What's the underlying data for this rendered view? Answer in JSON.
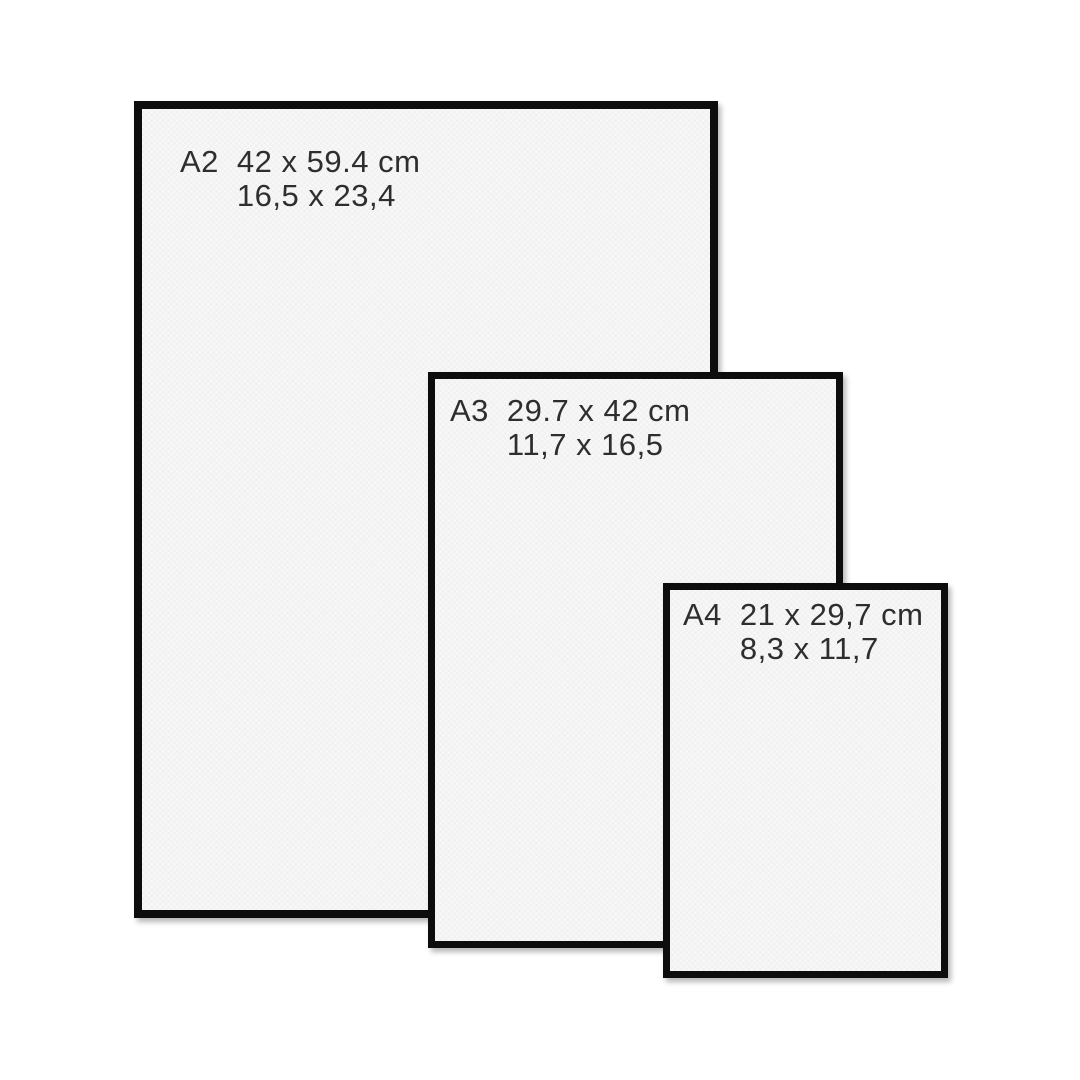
{
  "diagram": {
    "title": "frame-size-comparison",
    "colors": {
      "background": "#ffffff",
      "frame_border": "#0d0d0d",
      "paper": "#f8f8f8",
      "text": "#2e2e2e"
    }
  },
  "frames": [
    {
      "label": "A2",
      "size_cm": "42 x 59.4 cm",
      "size_inches": "16,5 x 23,4"
    },
    {
      "label": "A3",
      "size_cm": "29.7 x 42 cm",
      "size_inches": "11,7 x 16,5"
    },
    {
      "label": "A4",
      "size_cm": "21 x 29,7 cm",
      "size_inches": "8,3 x 11,7"
    }
  ]
}
